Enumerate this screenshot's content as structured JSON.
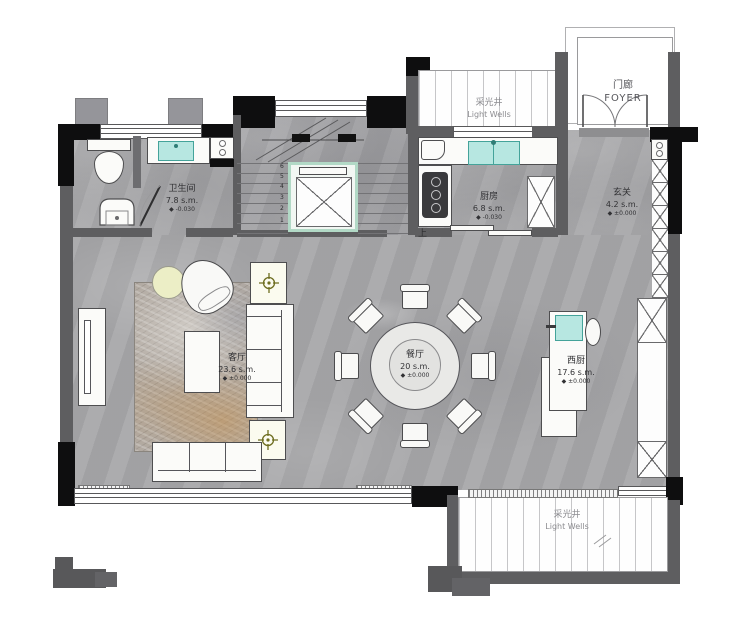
{
  "rooms": {
    "bathroom": {
      "name": "卫生间",
      "area": "7.8 s.m.",
      "level": "◆ -0.030"
    },
    "kitchen": {
      "name": "厨房",
      "area": "6.8 s.m.",
      "level": "◆ -0.030"
    },
    "entry": {
      "name": "玄关",
      "area": "4.2 s.m.",
      "level": "◆ ±0.000"
    },
    "foyer": {
      "name": "门廊",
      "name_en": "FOYER"
    },
    "light_well_top": {
      "name": "采光井",
      "name_en": "Light Wells"
    },
    "light_well_bottom": {
      "name": "采光井",
      "name_en": "Light Wells"
    },
    "dining": {
      "name": "餐厅",
      "area": "20 s.m.",
      "level": "◆ ±0.000"
    },
    "living": {
      "name": "客厅",
      "area": "23.6 s.m.",
      "level": "◆ ±0.000"
    },
    "west_kitchen": {
      "name": "西厨",
      "area": "17.6 s.m.",
      "level": "◆ ±0.000"
    }
  },
  "stairs": {
    "up_label": "上",
    "steps": [
      "6",
      "5",
      "4",
      "3",
      "2",
      "1"
    ]
  },
  "colors": {
    "floor_gray": "#a8a8aa",
    "wall_black": "#0e0e0f",
    "wall_gray": "#5e5e60",
    "fixture_teal": "#b7e7e1",
    "elevator_green": "#b2d9c6",
    "compass_olive": "#6e6e20",
    "rug_tan": "#c49254"
  }
}
